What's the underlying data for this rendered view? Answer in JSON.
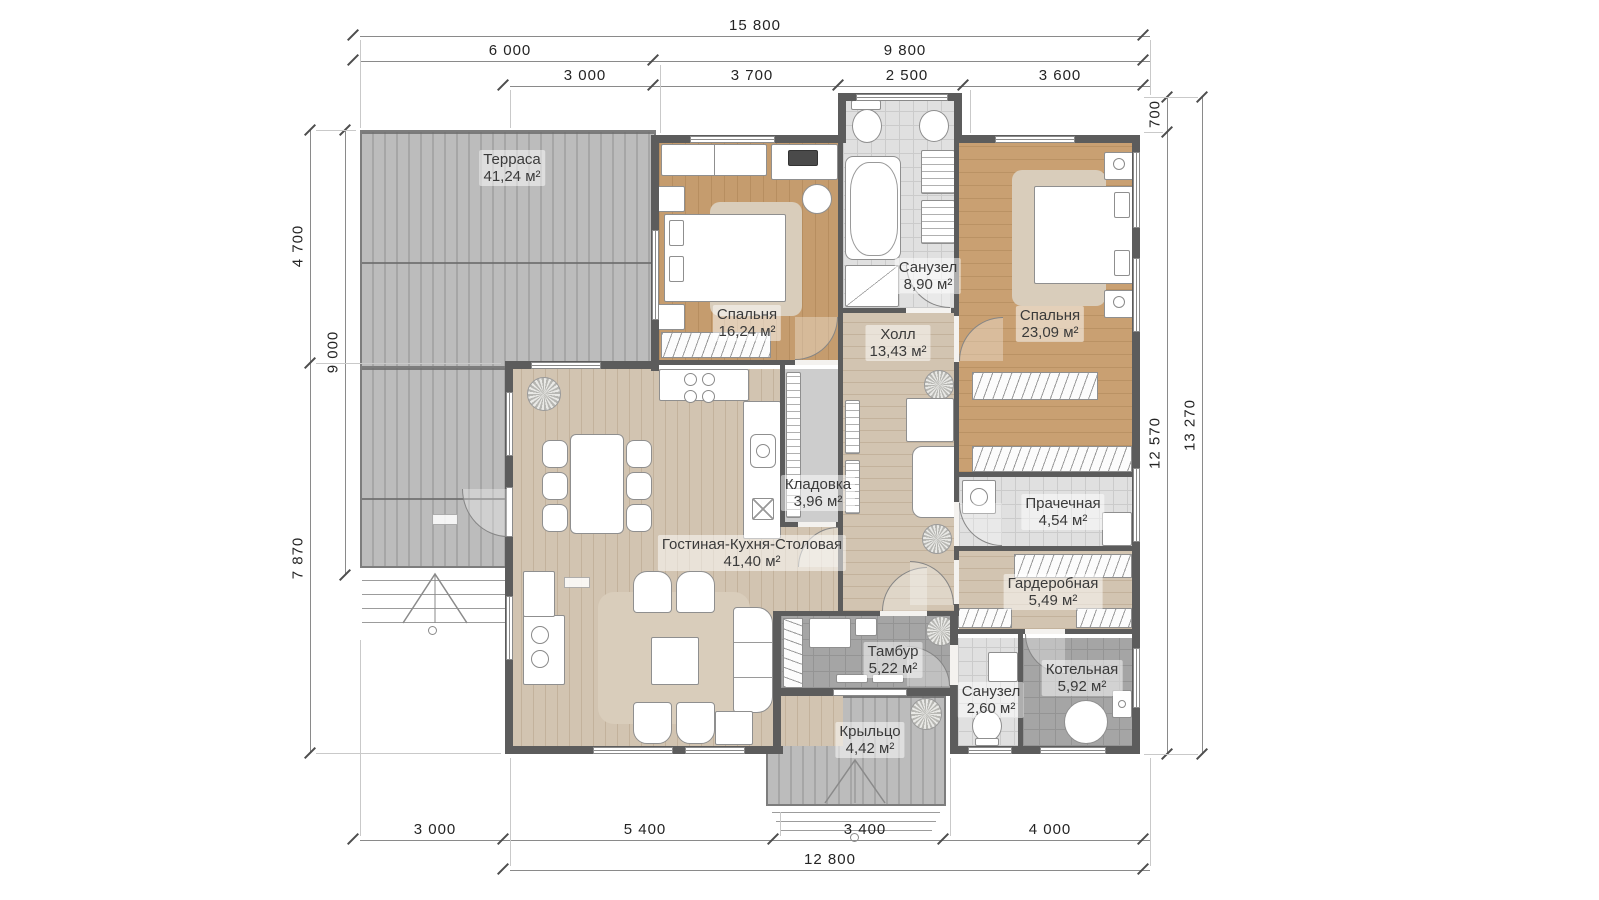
{
  "plan": {
    "rooms": {
      "terrace": {
        "name": "Терраса",
        "area": "41,24 м²"
      },
      "bedroom1": {
        "name": "Спальня",
        "area": "16,24 м²"
      },
      "bathroom1": {
        "name": "Санузел",
        "area": "8,90 м²"
      },
      "bedroom2": {
        "name": "Спальня",
        "area": "23,09 м²"
      },
      "hall": {
        "name": "Холл",
        "area": "13,43 м²"
      },
      "pantry": {
        "name": "Кладовка",
        "area": "3,96 м²"
      },
      "living": {
        "name": "Гостиная-Кухня-Столовая",
        "area": "41,40 м²"
      },
      "laundry": {
        "name": "Прачечная",
        "area": "4,54 м²"
      },
      "wardrobe": {
        "name": "Гардеробная",
        "area": "5,49 м²"
      },
      "vestibule": {
        "name": "Тамбур",
        "area": "5,22 м²"
      },
      "bathroom2": {
        "name": "Санузел",
        "area": "2,60 м²"
      },
      "boiler": {
        "name": "Котельная",
        "area": "5,92 м²"
      },
      "porch": {
        "name": "Крыльцо",
        "area": "4,42 м²"
      }
    },
    "dimensions": {
      "top_total": "15 800",
      "top_mid": [
        "6 000",
        "9 800"
      ],
      "top_inner": [
        "3 000",
        "3 700",
        "2 500",
        "3 600"
      ],
      "bottom_inner": [
        "3 000",
        "5 400",
        "3 400",
        "4 000"
      ],
      "bottom_total": "12 800",
      "left_outer": [
        "4 700",
        "7 870"
      ],
      "left_inner": "9 000",
      "right_inner": [
        "700",
        "12 570"
      ],
      "right_outer": "13 270"
    },
    "colors": {
      "wall": "#5c5c5c",
      "wood_bedroom": "#c59c6e",
      "wood_living": "#d2c4b1",
      "tile_light": "#e0e0e0",
      "tile_dark": "#a5a5a5",
      "deck": "#b5b5b5"
    }
  }
}
